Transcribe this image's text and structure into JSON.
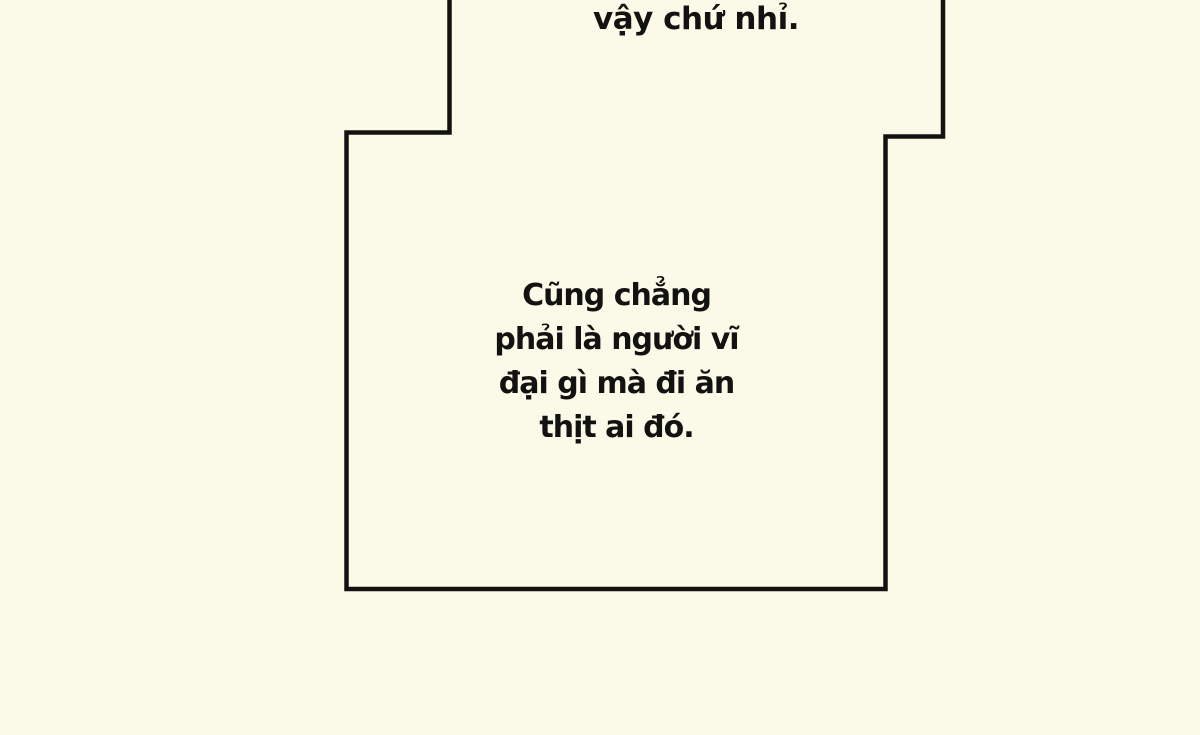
{
  "comic": {
    "background_color": "#fbfae9",
    "line_color": "#121210",
    "top_speech": {
      "text": "vậy chứ nhỉ."
    },
    "main_speech": {
      "lines": [
        "Cũng chẳng",
        "phải là người vĩ",
        "đại gì mà đi ăn",
        "thịt ai đó."
      ]
    }
  }
}
